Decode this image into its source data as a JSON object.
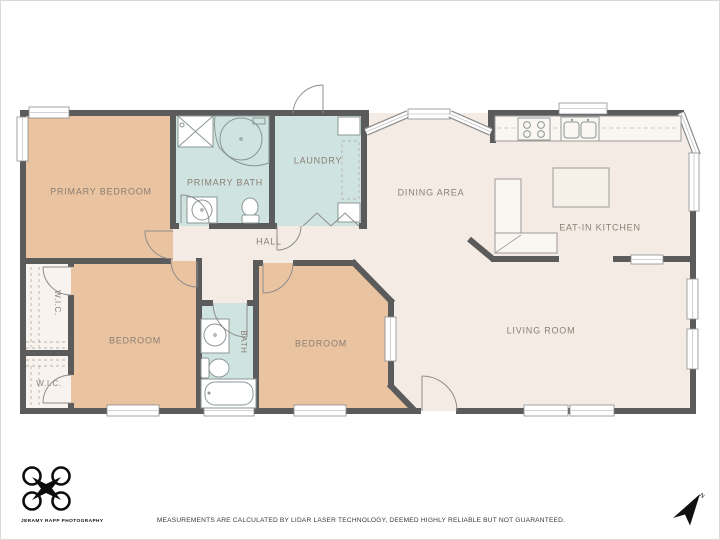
{
  "palette": {
    "wall": "#5b5b5b",
    "floor": "#f4ece4",
    "bedroom_fill": "#eac3a0",
    "bath_fill": "#cfe3e1",
    "closet_fill": "#f8f3ee",
    "label_color": "#8a7f74",
    "page_border": "#d9d9d9"
  },
  "rooms": {
    "primary_bedroom": {
      "label": "PRIMARY BEDROOM"
    },
    "primary_bath": {
      "label": "PRIMARY BATH"
    },
    "laundry": {
      "label": "LAUNDRY"
    },
    "dining": {
      "label": "DINING AREA"
    },
    "kitchen": {
      "label": "EAT-IN KITCHEN"
    },
    "hall": {
      "label": "HALL"
    },
    "wic1": {
      "label": "W.I.C."
    },
    "wic2": {
      "label": "W.I.C."
    },
    "bedroom1": {
      "label": "BEDROOM"
    },
    "bath2": {
      "label": "BATH"
    },
    "bedroom2": {
      "label": "BEDROOM"
    },
    "living": {
      "label": "LIVING ROOM"
    }
  },
  "footer": {
    "credit": "JERAMY RAPP PHOTOGRAPHY",
    "disclaimer": "MEASUREMENTS ARE CALCULATED BY LIDAR LASER TECHNOLOGY, DEEMED HIGHLY RELIABLE BUT NOT GUARANTEED.",
    "north_label": "N"
  }
}
